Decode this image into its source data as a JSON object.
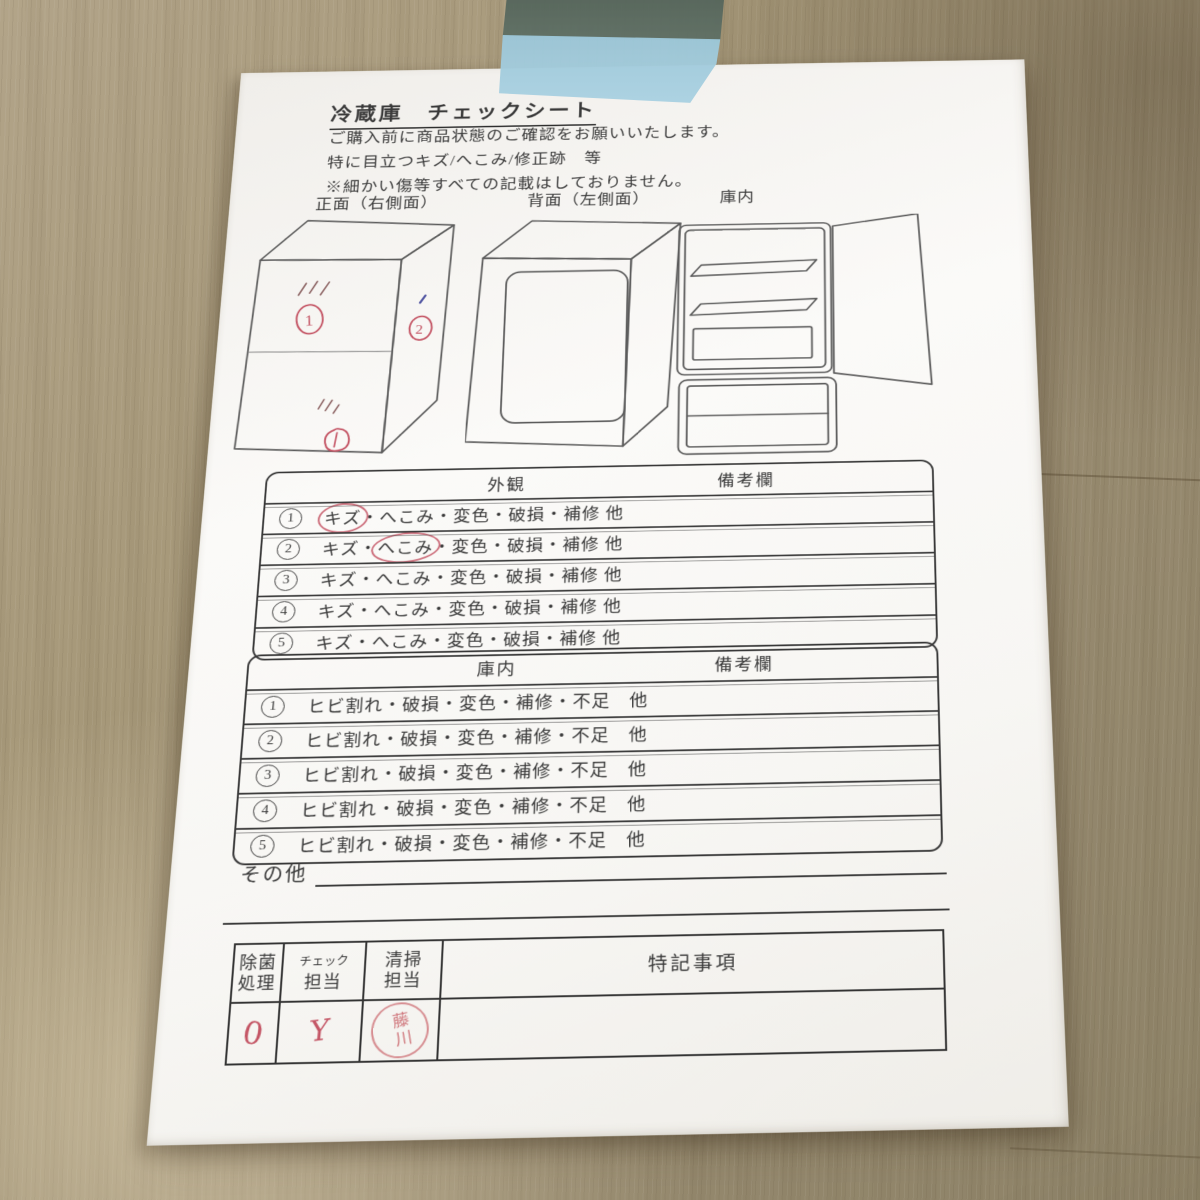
{
  "colors": {
    "red_pen": "#c45565",
    "blue_pen": "#4a4f9e",
    "stamp_red": "#c65862",
    "tape_blue": "#a3ccdc",
    "paper_white": "#f8f7f4",
    "wood_base": "#9d9076",
    "ink": "#3a3a3a"
  },
  "paper": {
    "title": "冷蔵庫　チェックシート",
    "intro_lines": [
      "ご購入前に商品状態のご確認をお願いいたします。",
      "特に目立つキズ/へこみ/修正跡　等",
      "※細かい傷等すべての記載はしておりません。"
    ],
    "diagram_labels": {
      "front": "正面（右側面）",
      "back": "背面（左側面）",
      "interior": "庫内"
    },
    "front_view_marks": {
      "mark1": "1",
      "mark2": "2",
      "mark3": "1"
    },
    "exterior_table": {
      "title": "外観",
      "remarks_header": "備考欄",
      "rows": [
        {
          "num": "1",
          "text": "キズ・へこみ・変色・破損・補修 他",
          "circled": "キズ",
          "remark": ""
        },
        {
          "num": "2",
          "text": "キズ・へこみ・変色・破損・補修 他",
          "circled": "へこみ",
          "remark": ""
        },
        {
          "num": "3",
          "text": "キズ・へこみ・変色・破損・補修 他",
          "circled": "",
          "remark": ""
        },
        {
          "num": "4",
          "text": "キズ・へこみ・変色・破損・補修 他",
          "circled": "",
          "remark": ""
        },
        {
          "num": "5",
          "text": "キズ・へこみ・変色・破損・補修 他",
          "circled": "",
          "remark": ""
        }
      ]
    },
    "interior_table": {
      "title": "庫内",
      "remarks_header": "備考欄",
      "rows": [
        {
          "num": "1",
          "text": "ヒビ割れ・破損・変色・補修・不足　他",
          "circled": "",
          "remark": ""
        },
        {
          "num": "2",
          "text": "ヒビ割れ・破損・変色・補修・不足　他",
          "circled": "",
          "remark": ""
        },
        {
          "num": "3",
          "text": "ヒビ割れ・破損・変色・補修・不足　他",
          "circled": "",
          "remark": ""
        },
        {
          "num": "4",
          "text": "ヒビ割れ・破損・変色・補修・不足　他",
          "circled": "",
          "remark": ""
        },
        {
          "num": "5",
          "text": "ヒビ割れ・破損・変色・補修・不足　他",
          "circled": "",
          "remark": ""
        }
      ]
    },
    "other_label": "その他",
    "sign_table": {
      "col_disinfect": [
        "除菌",
        "処理"
      ],
      "col_check": [
        "チェック",
        "担当"
      ],
      "col_cleaning": [
        "清掃",
        "担当"
      ],
      "col_notes": "特記事項",
      "disinfect_mark": "0",
      "check_mark": "Y",
      "cleaning_stamp": "藤川",
      "notes_value": ""
    }
  }
}
